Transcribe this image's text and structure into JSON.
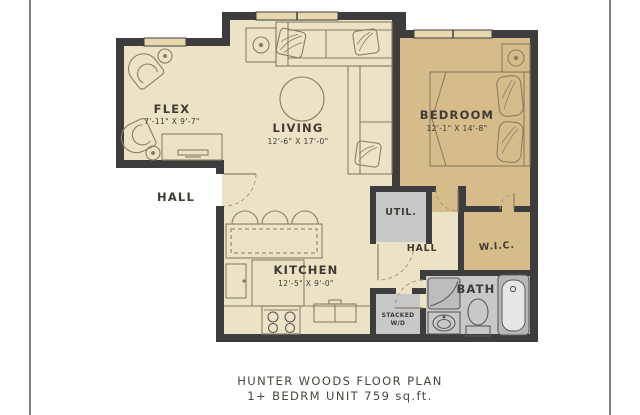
{
  "plan": {
    "rooms": {
      "flex": {
        "name": "FLEX",
        "dims": "7'-11\" X 9'-7\""
      },
      "living": {
        "name": "LIVING",
        "dims": "12'-6\" X 17'-0\""
      },
      "bedroom": {
        "name": "BEDROOM",
        "dims": "12'-1\" X 14'-8\""
      },
      "kitchen": {
        "name": "KITCHEN",
        "dims": "12'-5\" X 9'-0\""
      },
      "hall_outside": {
        "name": "HALL"
      },
      "hall_inside": {
        "name": "HALL"
      },
      "util": {
        "name": "UTIL."
      },
      "wic": {
        "name": "W.I.C."
      },
      "bath": {
        "name": "BATH"
      },
      "laundry": {
        "name_line1": "STACKED",
        "name_line2": "W/D"
      }
    },
    "caption": {
      "line1": "HUNTER WOODS FLOOR PLAN",
      "line2": "1+  BEDRM UNIT 759 sq.ft."
    },
    "colors": {
      "wall": "#3d3d3d",
      "floor_main": "#ece2c5",
      "floor_bedroom": "#d6bc8b",
      "floor_closet": "#c8c8c8",
      "window": "#e7d9ad",
      "furniture_line": "#8a7f63",
      "text": "#3f3b35",
      "page_frame_line": "#7e7e7e"
    }
  }
}
